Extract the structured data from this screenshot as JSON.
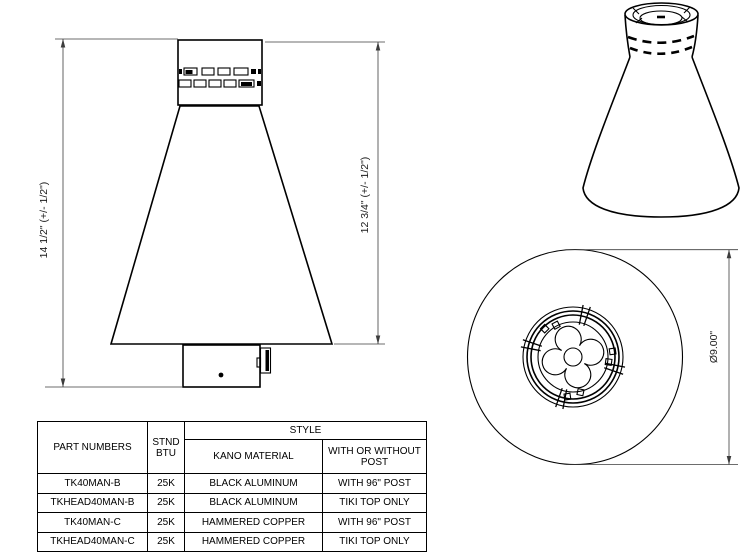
{
  "drawing": {
    "description": "tiki-torch-head-technical-drawing",
    "dims": {
      "front_left": "14 1/2\" (+/- 1/2\")",
      "front_right": "12 3/4\" (+/- 1/2\")",
      "top_diameter": "Ø9.00\""
    }
  },
  "table": {
    "headers": {
      "part_numbers": "PART NUMBERS",
      "stnd_btu": "STND BTU",
      "style": "STYLE",
      "kano_material": "KANO MATERIAL",
      "with_or_without_post": "WITH OR WITHOUT POST"
    },
    "rows": [
      {
        "part": "TK40MAN-B",
        "btu": "25K",
        "material": "BLACK ALUMINUM",
        "post": "WITH 96\" POST"
      },
      {
        "part": "TKHEAD40MAN-B",
        "btu": "25K",
        "material": "BLACK ALUMINUM",
        "post": "TIKI TOP ONLY"
      },
      {
        "part": "TK40MAN-C",
        "btu": "25K",
        "material": "HAMMERED COPPER",
        "post": "WITH 96\" POST"
      },
      {
        "part": "TKHEAD40MAN-C",
        "btu": "25K",
        "material": "HAMMERED COPPER",
        "post": "TIKI TOP ONLY"
      }
    ]
  },
  "colors": {
    "line": "#000000",
    "dimension_line": "#3c3c3c",
    "background": "#ffffff"
  }
}
